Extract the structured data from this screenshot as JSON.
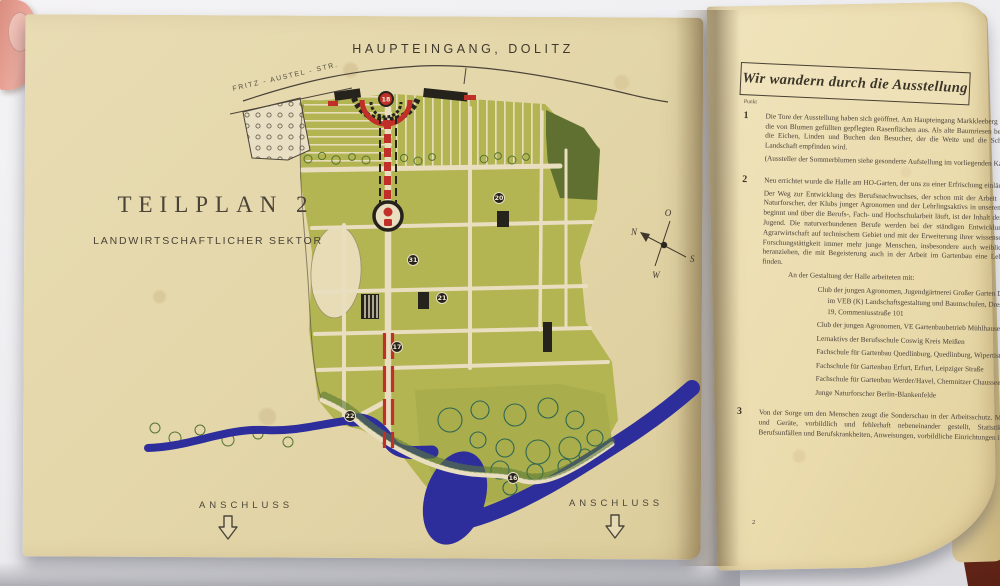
{
  "map_page": {
    "entrance_label": "HAUPTEINGANG, DOLITZ",
    "street_label": "FRITZ - AUSTEL - STR.",
    "plan_title": "TEILPLAN 2",
    "plan_subtitle": "LANDWIRTSCHAFTLICHER SEKTOR",
    "compass": {
      "n": "N",
      "o": "O",
      "s": "S",
      "w": "W"
    },
    "markers": [
      {
        "label": "18"
      },
      {
        "label": "20"
      },
      {
        "label": "31"
      },
      {
        "label": "21"
      },
      {
        "label": "17"
      },
      {
        "label": "22"
      },
      {
        "label": "16"
      }
    ],
    "anschluss_left": "ANSCHLUSS",
    "anschluss_right": "ANSCHLUSS"
  },
  "text_page": {
    "heading": "Wir wandern durch die Ausstellung",
    "margin_label": "Punkt",
    "page_number": "2",
    "items": [
      {
        "number": "1",
        "paragraphs": [
          "Die Tore der Ausstellung haben sich geöffnet. Am Haupteingang Markkleeberg breiten sich die von Blumen gefüllten gepflegten Rasenflächen aus. Als alte Baumriesen beeindrucken die Eichen, Linden und Buchen den Besucher, der die Weite und die Schönheit der Landschaft empfinden wird.",
          "(Aussteller der Sommerblumen siehe gesonderte Aufstellung im vorliegenden Katalog.)"
        ]
      },
      {
        "number": "2",
        "paragraphs": [
          "Neu errichtet wurde die Halle am HO-Garten, der uns zu einer Erfrischung einlädt.",
          "Der Weg zur Entwicklung des Berufsnachwuchses, der schon mit der Arbeit der jungen Naturforscher, der Klubs junger Agronomen und der Lehrlingsaktivs in unseren Betrieben beginnt und über die Berufs-, Fach- und Hochschularbeit läuft, ist der Inhalt der Halle der Jugend. Die naturverbundenen Berufe werden bei der ständigen Entwicklung unserer Agrarwirtschaft auf technischem Gebiet und mit der Erweiterung ihrer wissenschaftlichen Forschungstätigkeit immer mehr junge Menschen, insbesondere auch weibliche Kräfte heranziehen, die mit Begeisterung auch in der Arbeit im Gartenbau eine Lebensfreude finden."
        ],
        "list_intro": "An der Gestaltung der Halle arbeiteten mit:",
        "list": [
          "Club der jungen Agronomen, Jugendgärtnerei Großer Garten Dresden im VEB (K) Landschaftsgestaltung und Baumschulen, Dresden A 19, Commeniusstraße 101",
          "Club der jungen Agronomen, VE Gartenbaubetrieb Mühlhausen",
          "Lernaktivs der Berufsschule Coswig Kreis Meißen",
          "Fachschule für Gartenbau Quedlinburg, Quedlinburg, Wipertistraße 5-6",
          "Fachschule für Gartenbau Erfurt, Erfurt, Leipziger Straße",
          "Fachschule für Gartenbau Werder/Havel, Chemnitzer Chaussee 138-140",
          "Junge Naturforscher Berlin-Blankenfelde"
        ]
      },
      {
        "number": "3",
        "paragraphs": [
          "Von der Sorge um den Menschen zeugt die Sonderschau in der Arbeitsschutz. Maschinen und Geräte, vorbildlich und fehlerhaft nebeneinander gestellt, Statistiken von Berufsunfällen und Berufskrankheiten, Anweisungen, vorbildliche Einrichtungen im"
        ]
      }
    ]
  },
  "palette": {
    "page_cream": "#e6d9ad",
    "map_green": "#b3b452",
    "map_dark_green": "#5f7030",
    "river_blue": "#2e2d9c",
    "accent_red": "#c03028",
    "ink_black": "#26221c"
  }
}
